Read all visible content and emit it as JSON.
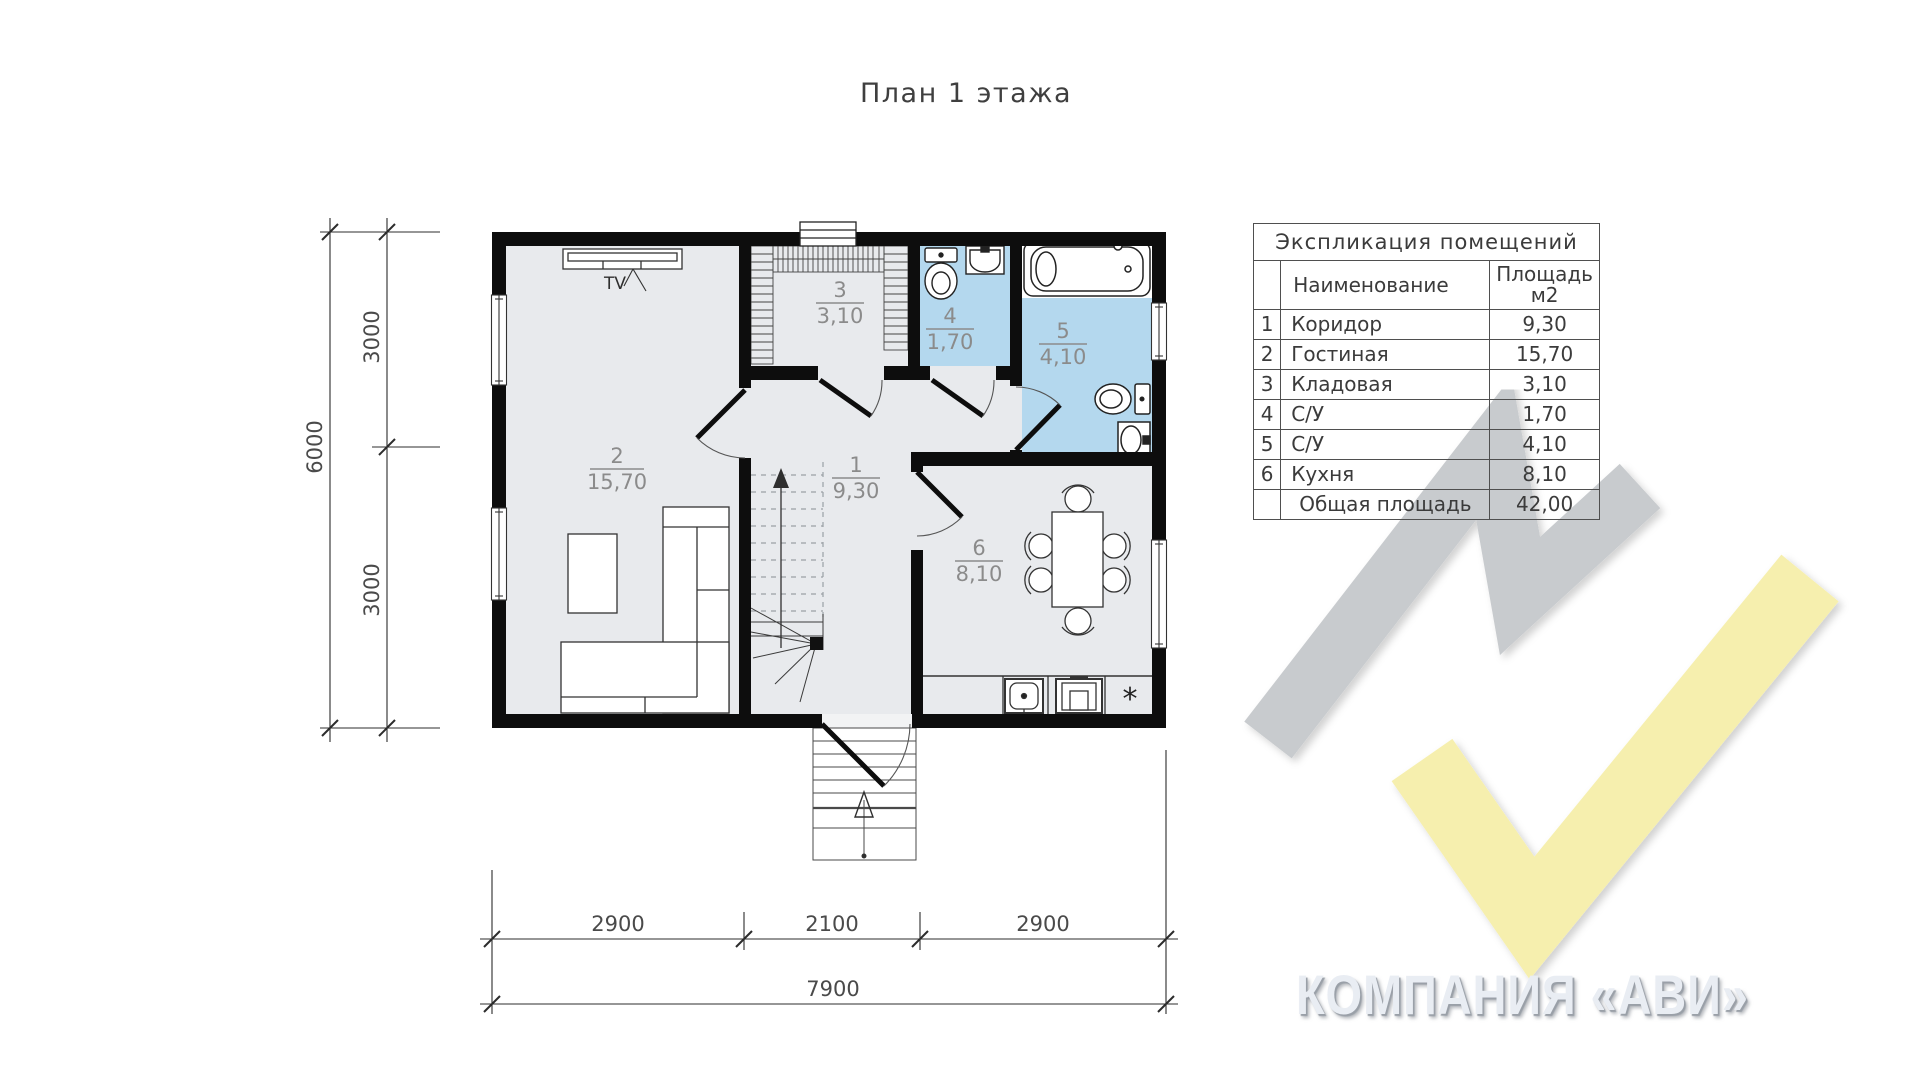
{
  "title": "План 1 этажа",
  "plan": {
    "rooms": [
      {
        "number": "1",
        "area": "9,30"
      },
      {
        "number": "2",
        "area": "15,70"
      },
      {
        "number": "3",
        "area": "3,10"
      },
      {
        "number": "4",
        "area": "1,70"
      },
      {
        "number": "5",
        "area": "4,10"
      },
      {
        "number": "6",
        "area": "8,10"
      }
    ],
    "tv_label": "TV",
    "fridge_symbol": "*",
    "dimensions": {
      "left_total": "6000",
      "left_segments": [
        "3000",
        "3000"
      ],
      "bottom_segments": [
        "2900",
        "2100",
        "2900"
      ],
      "bottom_total": "7900"
    }
  },
  "table": {
    "title": "Экспликация помещений",
    "columns": {
      "name": "Наименование",
      "area_line1": "Площадь",
      "area_line2": "м2"
    },
    "rows": [
      {
        "num": "1",
        "name": "Коридор",
        "area": "9,30"
      },
      {
        "num": "2",
        "name": "Гостиная",
        "area": "15,70"
      },
      {
        "num": "3",
        "name": "Кладовая",
        "area": "3,10"
      },
      {
        "num": "4",
        "name": "С/У",
        "area": "1,70"
      },
      {
        "num": "5",
        "name": "С/У",
        "area": "4,10"
      },
      {
        "num": "6",
        "name": "Кухня",
        "area": "8,10"
      },
      {
        "num": "",
        "name": "Общая площадь",
        "area": "42,00"
      }
    ]
  },
  "watermark": {
    "company": "КОМПАНИЯ «АВИ»",
    "colors": {
      "gray": "#c8cbce",
      "yellow": "#f6efae",
      "room_blue": "#b4d8ee",
      "room_gray": "#e8eaed"
    }
  }
}
